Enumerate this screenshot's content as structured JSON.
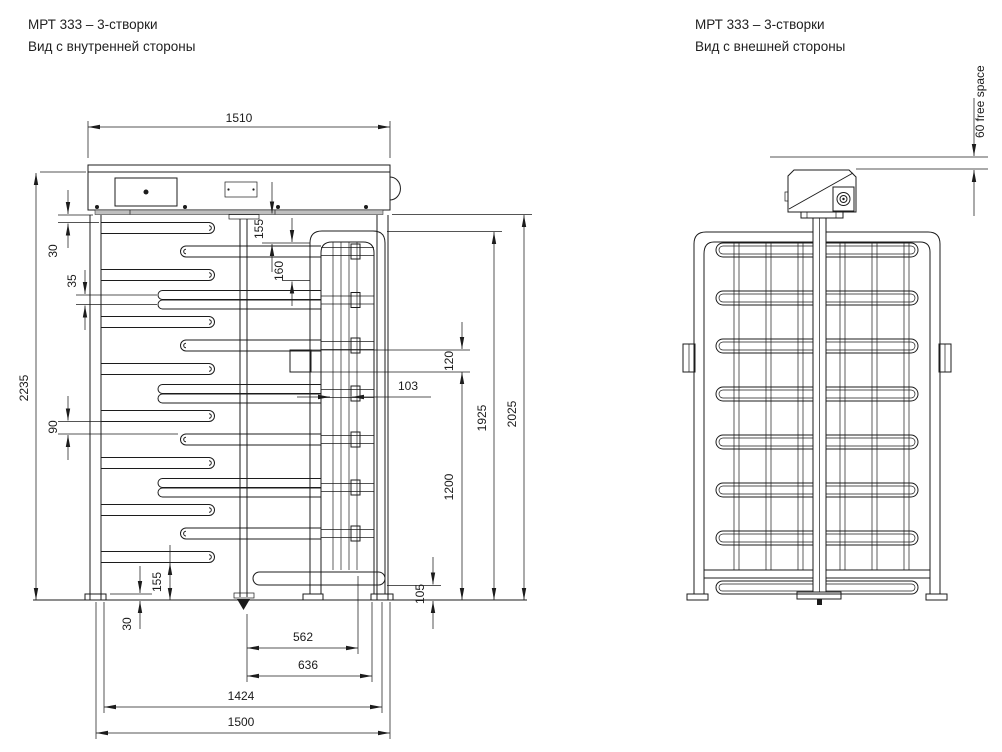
{
  "left_view": {
    "title": "МРТ 333 – 3-створки",
    "subtitle": "Вид с внутренней стороны",
    "dims": {
      "d1510": "1510",
      "d2235": "2235",
      "d30_top": "30",
      "d35": "35",
      "d90": "90",
      "d155_top": "155",
      "d160": "160",
      "d120": "120",
      "d103": "103",
      "d1925": "1925",
      "d2025": "2025",
      "d1200": "1200",
      "d105": "105",
      "d155_bottom": "155",
      "d30_bottom": "30",
      "d562": "562",
      "d636": "636",
      "d1424": "1424",
      "d1500": "1500"
    }
  },
  "right_view": {
    "title": "МРТ 333 – 3-створки",
    "subtitle": "Вид с внешней стороны",
    "dims": {
      "d60": "60  free space"
    }
  },
  "colors": {
    "line": "#1c1c1c",
    "background": "#ffffff"
  }
}
